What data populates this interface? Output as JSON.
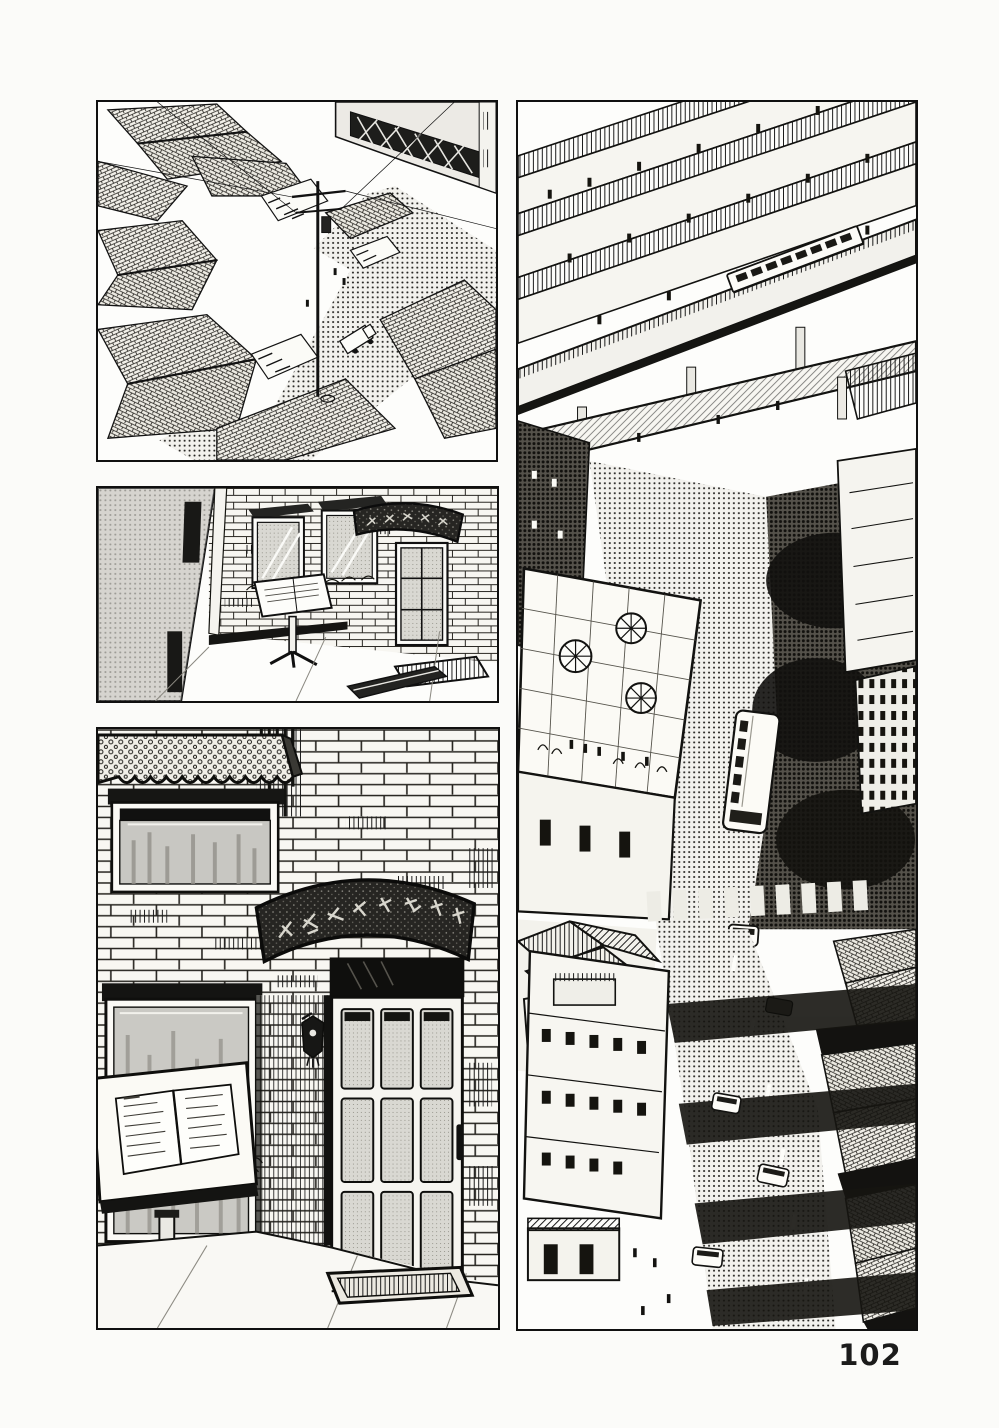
{
  "page": {
    "number": "102",
    "paper_color": "#fbfbf9",
    "ink_color": "#171717"
  },
  "panels": [
    {
      "name": "rooftops-aerial",
      "description": "Bird's-eye view of a dense old neighborhood: clusters of tiled roofs, shop awnings, a telephone pole with wires above a small crossroads, a street with a tiny truck, and a tall concrete building in the upper right."
    },
    {
      "name": "bistro-front",
      "sign_text": "ビストロ・ド・ミレーユ",
      "description": "Street-level view of a small brick bistro beside a shaded building corner: arched name sign, two framed windows, a glass door, a standing menu lectern and a doormat on the sidewalk."
    },
    {
      "name": "bistro-entrance",
      "sign_text": "ビストロ・ド・ミレーユ",
      "description": "Close view of the bistro entrance: scalloped awning over a window, white brick wall, arched speckled name sign, nine-paned glass door with wall lantern, standing menu lectern, small bush and doormat."
    },
    {
      "name": "city-street-aerial",
      "description": "Tall aerial view of a modern district: elevated railway bands and a pedestrian footbridge with a train, a rooftop terrace with parasols and tiny figures, a bus and cars on a shadow-streaked street that curves past shop awnings and rows of tiled roofs."
    }
  ]
}
